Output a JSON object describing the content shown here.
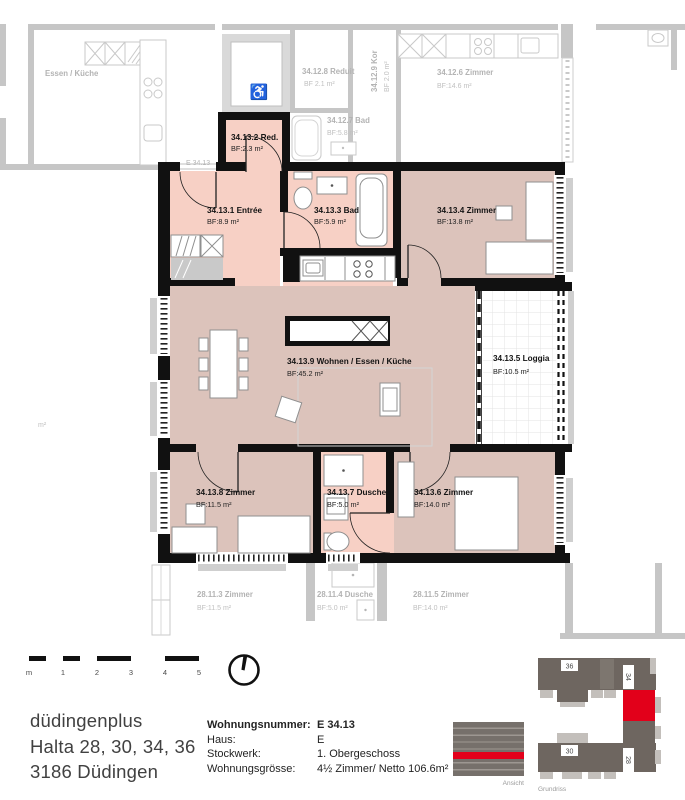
{
  "floorplan": {
    "entry_tag": "E 34.13",
    "faint_area_label": "m²",
    "rooms": [
      {
        "name": "34.13.1 Entrée",
        "area": "BF:8.9 m²"
      },
      {
        "name": "34.13.2 Red.",
        "area": "BF:2.3 m²"
      },
      {
        "name": "34.13.3 Bad",
        "area": "BF:5.9 m²"
      },
      {
        "name": "34.13.4 Zimmer",
        "area": "BF:13.8 m²"
      },
      {
        "name": "34.13.5 Loggia",
        "area": "BF:10.5 m²"
      },
      {
        "name": "34.13.6 Zimmer",
        "area": "BF:14.0 m²"
      },
      {
        "name": "34.13.7 Dusche",
        "area": "BF:5.0 m²"
      },
      {
        "name": "34.13.8 Zimmer",
        "area": "BF:11.5 m²"
      },
      {
        "name": "34.13.9 Wohnen / Essen / Küche",
        "area": "BF:45.2 m²"
      }
    ],
    "neighbor_rooms": [
      {
        "name": "Essen / Küche",
        "area": ""
      },
      {
        "name": "34.12.8 Reduit",
        "area": "BF 2.1 m²"
      },
      {
        "name": "34.12.9 Kor",
        "area": "BF 2.0 m²"
      },
      {
        "name": "34.12.6 Zimmer",
        "area": "BF:14.6 m²"
      },
      {
        "name": "34.12.7 Bad",
        "area": "BF:5.8 m²"
      },
      {
        "name": "28.11.3 Zimmer",
        "area": "BF:11.5 m²"
      },
      {
        "name": "28.11.4 Dusche",
        "area": "BF:5.0 m²"
      },
      {
        "name": "28.11.5 Zimmer",
        "area": "BF:14.0 m²"
      }
    ]
  },
  "scalebar": {
    "labels": [
      "m",
      "1",
      "2",
      "3",
      "4",
      "5"
    ]
  },
  "address": {
    "line1": "düdingenplus",
    "line2": "Halta 28, 30, 34, 36",
    "line3": "3186 Düdingen"
  },
  "apartment_info": {
    "rows": [
      {
        "label": "Wohnungsnummer:",
        "value": "E 34.13"
      },
      {
        "label": "Haus:",
        "value": "E"
      },
      {
        "label": "Stockwerk:",
        "value": "1. Obergeschoss"
      },
      {
        "label": "Wohnungsgrösse:",
        "value": "4½ Zimmer/ Netto 106.6m²"
      }
    ]
  },
  "locator": {
    "ansicht_label": "Ansicht",
    "grundriss_label": "Grundriss",
    "building_numbers": [
      "36",
      "34",
      "30",
      "28"
    ],
    "highlight_color": "#e2001a"
  },
  "colors": {
    "room_bright": "#f7d0c5",
    "room_dusty": "#dcc3bb",
    "walls": "#111111",
    "faded": "#c6c6c6",
    "highlight": "#e2001a"
  }
}
